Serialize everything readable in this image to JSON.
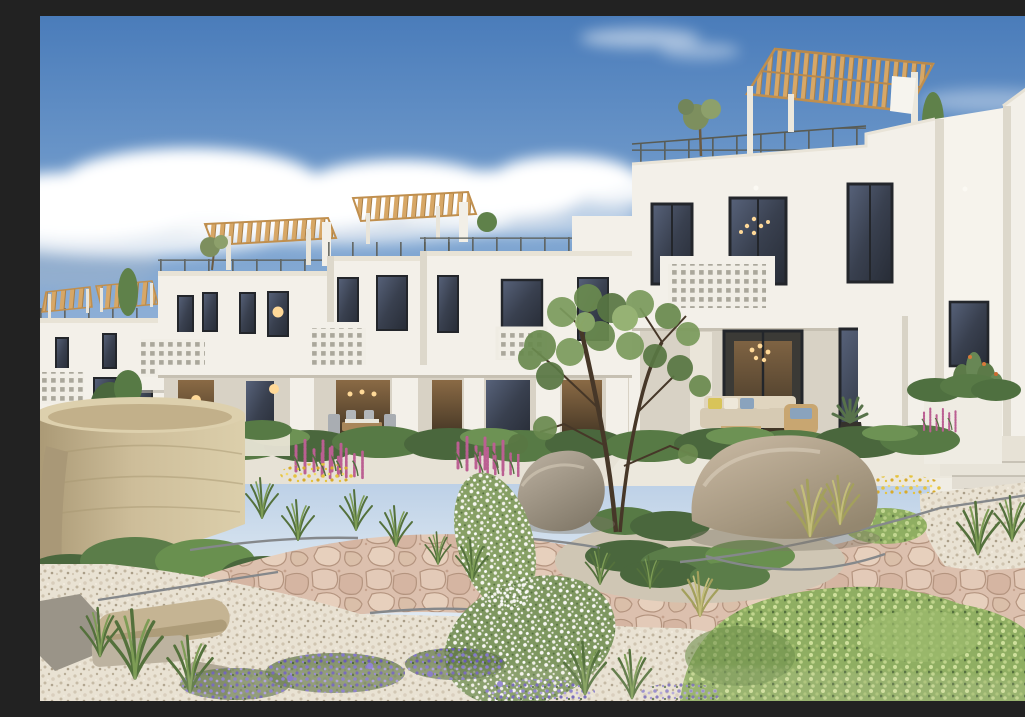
{
  "scene": {
    "type": "photorealistic-architectural-render",
    "description": "Exterior rendering of a new-build complex of white Mediterranean two-storey townhouses with timber rooftop pergolas, black-framed windows, perforated breeze-block balconies and covered terraces, fronted by a drought-tolerant gravel garden with a winding pink flagstone path, a round travertine planter, boulders, rosemary shrubs, ornamental grasses and purple, white, magenta and yellow wildflowers under a blue sky with scattered clouds",
    "labels": {
      "image": "architectural rendering of white townhouses and gravel garden",
      "sky": "clear blue sky",
      "clouds": "scattered white cumulus clouds",
      "buildings": "row of white two-storey townhouses receding to the left",
      "building_far_left": "farthest townhouse block with small pergolas",
      "building_left": "left townhouse with rooftop pergola and breeze-block balcony",
      "building_mid_left": "middle-left townhouse with rooftop pergola",
      "building_mid": "middle townhouse with juliet breeze-block balcony",
      "building_main": "nearest large townhouse with rooftop pergola, balcony and covered terrace",
      "tower_right": "tall white side building with louvered vent",
      "garden": "xeriscape garden with gravel, flagstone path, boulders and wildflowers",
      "stone_planter": "large round travertine stone planter",
      "path": "winding pink flagstone path with steel edging",
      "boulders": "large granite boulders",
      "center_tree": "small multi-stem tree in the central planting island",
      "steps": "light concrete steps beside the main house",
      "lounge": "outdoor lounge set with beige sofas and colourful cushions",
      "dining": "outdoor dining table with grey chairs"
    }
  },
  "palette": {
    "sky_top": "#4a7cba",
    "sky_mid": "#7ba3d0",
    "sky_horizon": "#d9e5f0",
    "cloud": "#ffffff",
    "wall": "#f3f0e9",
    "wall_shade": "#e2ddd1",
    "wall_dark": "#cfc9bb",
    "porch_shadow": "#d8d2c5",
    "window_frame": "#23262b",
    "window_glass": "#3a4250",
    "pergola_wood": "#d7a766",
    "railing": "#595b53",
    "breeze_hole": "#aaa79b",
    "hedge": "#4a673d",
    "shrub": "#5f814a",
    "grass_light": "#8fae62",
    "leaf_light": "#a9c274",
    "stone_sand": "#c9b892",
    "gravel": "#e9e2d3",
    "path_stone": "#dcc0ae",
    "path_joint": "#b4947f",
    "boulder": "#b3a28d",
    "metal_edge": "#85888b",
    "step": "#e8e4d9",
    "flower_purple": "#7e70c5",
    "flower_magenta": "#bb5f92",
    "flower_yellow": "#e5c33f",
    "flower_white": "#f7f7f2",
    "warm_light": "#ffd998",
    "wood_furniture": "#a8865a",
    "cushion_yellow": "#d8c459",
    "cushion_blue": "#8aa3bd",
    "sofa": "#e0d5bf",
    "pot_dark": "#35322c"
  }
}
